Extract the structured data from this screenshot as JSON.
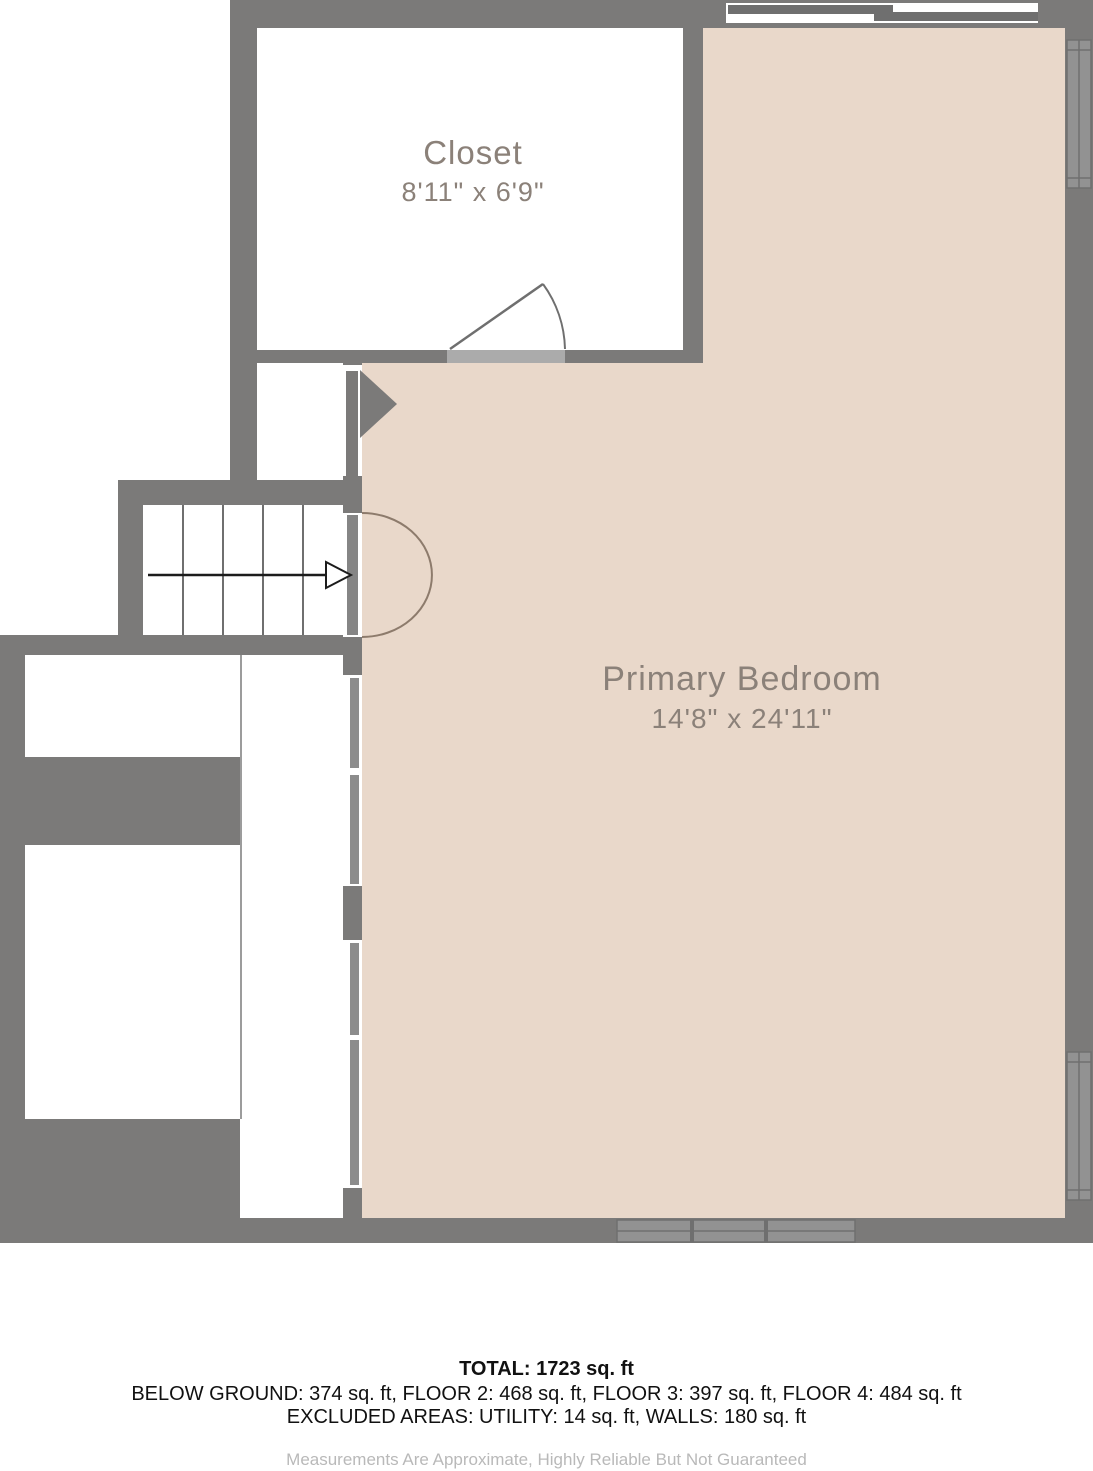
{
  "floorplan": {
    "rooms": [
      {
        "name": "Closet",
        "dimensions": "8'11\" x 6'9\""
      },
      {
        "name": "Primary Bedroom",
        "dimensions": "14'8\" x 24'11\""
      }
    ],
    "features": [
      "stairs-with-direction-arrow",
      "closet-door-swing",
      "bedroom-door-swing",
      "vestibule-door-triangle",
      "sliding-door-top-wall",
      "window-right-top",
      "window-right-bottom",
      "window-bottom-wall"
    ],
    "colors": {
      "wall": "#7b7a79",
      "floor_bedroom": "#e9d8ca",
      "floor_other": "#ffffff",
      "window_fill": "#929292",
      "window_line": "#6f6f6f",
      "door_arc": "#8d7b6c",
      "door_threshold": "#ababab",
      "room_label_text": "#8b8179",
      "footer_text": "#111111",
      "disclaimer_text": "#b9b9b9"
    }
  },
  "footer": {
    "total": "TOTAL: 1723 sq. ft",
    "floors": "BELOW GROUND: 374 sq. ft, FLOOR 2: 468 sq. ft, FLOOR 3: 397 sq. ft, FLOOR 4: 484 sq. ft",
    "excluded": "EXCLUDED AREAS: UTILITY: 14 sq. ft, WALLS: 180 sq. ft",
    "disclaimer": "Measurements Are Approximate, Highly Reliable But Not Guaranteed"
  }
}
